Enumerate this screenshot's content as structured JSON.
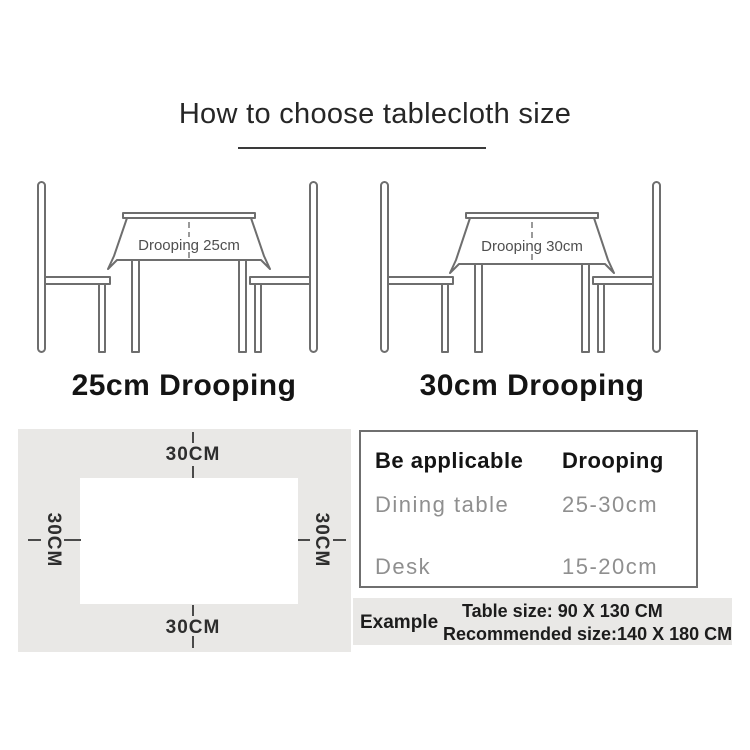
{
  "title": "How to choose tablecloth size",
  "illustrations": [
    {
      "cloth_label": "Drooping 25cm",
      "caption": "25cm Drooping"
    },
    {
      "cloth_label": "Drooping 30cm",
      "caption": "30cm Drooping"
    }
  ],
  "size_diagram": {
    "top_label": "30CM",
    "bottom_label": "30CM",
    "left_label": "30CM",
    "right_label": "30CM"
  },
  "spec_table": {
    "header": {
      "col1": "Be applicable",
      "col2": "Drooping"
    },
    "rows": [
      {
        "name": "Dining table",
        "value": "25-30cm"
      },
      {
        "name": "Desk",
        "value": "15-20cm"
      }
    ]
  },
  "example": {
    "label": "Example",
    "table_size_line": "Table size:  90 X 130 CM",
    "recommended_line": "Recommended size:140 X 180 CM"
  },
  "colors": {
    "panel_gray": "#e9e8e6",
    "line_gray": "#6e6e6e",
    "heading_dark": "#141414",
    "row_gray": "#8f8f8f",
    "cloth_text_gray": "#4f4f4f"
  }
}
